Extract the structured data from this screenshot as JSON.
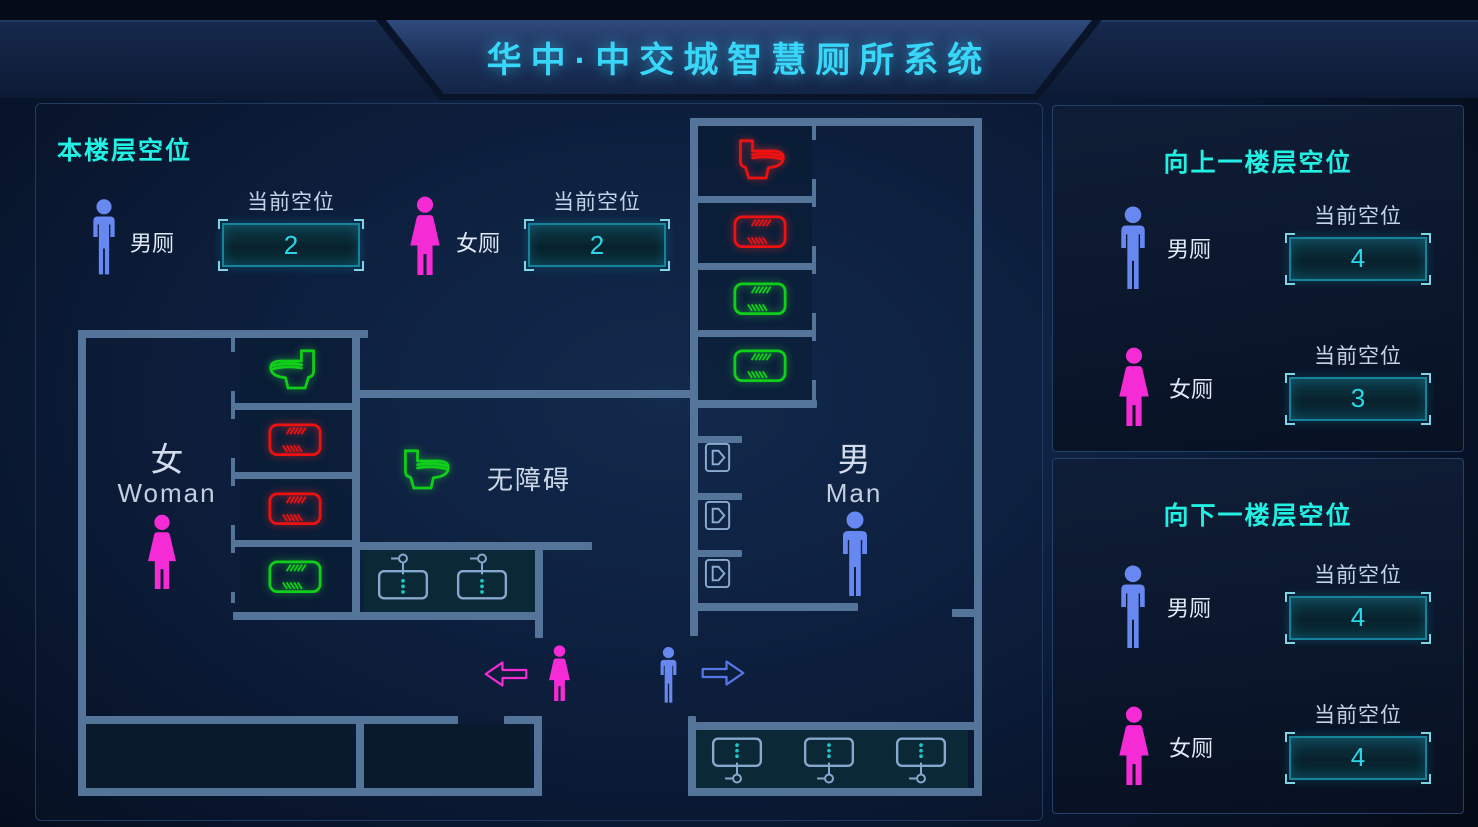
{
  "header": {
    "title": "华中·中交城智慧厕所系统"
  },
  "current_floor": {
    "heading": "本楼层空位",
    "stats": [
      {
        "gender": "male",
        "label": "男厕",
        "counter_label": "当前空位",
        "value": "2"
      },
      {
        "gender": "female",
        "label": "女厕",
        "counter_label": "当前空位",
        "value": "2"
      }
    ],
    "plan": {
      "women_room": {
        "label_cn": "女",
        "label_en": "Woman"
      },
      "men_room": {
        "label_cn": "男",
        "label_en": "Man"
      },
      "accessible_label": "无障碍",
      "women_stalls": [
        {
          "type": "toilet",
          "status": "vacant",
          "facing": "left"
        },
        {
          "type": "squat",
          "status": "occupied"
        },
        {
          "type": "squat",
          "status": "occupied"
        },
        {
          "type": "squat",
          "status": "vacant"
        }
      ],
      "men_stalls": [
        {
          "type": "toilet",
          "status": "occupied",
          "facing": "right"
        },
        {
          "type": "squat",
          "status": "occupied"
        },
        {
          "type": "squat",
          "status": "vacant"
        },
        {
          "type": "squat",
          "status": "vacant"
        }
      ],
      "accessible_stall": {
        "type": "toilet",
        "status": "vacant",
        "facing": "right"
      },
      "urinal_count": 3,
      "washstand_sinks": 2,
      "lobby_sinks": 3
    }
  },
  "upper_floor": {
    "heading": "向上一楼层空位",
    "rows": [
      {
        "gender": "male",
        "label": "男厕",
        "counter_label": "当前空位",
        "value": "4"
      },
      {
        "gender": "female",
        "label": "女厕",
        "counter_label": "当前空位",
        "value": "3"
      }
    ]
  },
  "lower_floor": {
    "heading": "向下一楼层空位",
    "rows": [
      {
        "gender": "male",
        "label": "男厕",
        "counter_label": "当前空位",
        "value": "4"
      },
      {
        "gender": "female",
        "label": "女厕",
        "counter_label": "当前空位",
        "value": "4"
      }
    ]
  },
  "colors": {
    "occupied": "#ef1010",
    "vacant": "#10cf18",
    "male": "#6688f0",
    "female": "#f52bd5",
    "title": "#38d6f8",
    "heading": "#21f0e3",
    "value": "#2bd7e9",
    "wall": "#547499"
  }
}
